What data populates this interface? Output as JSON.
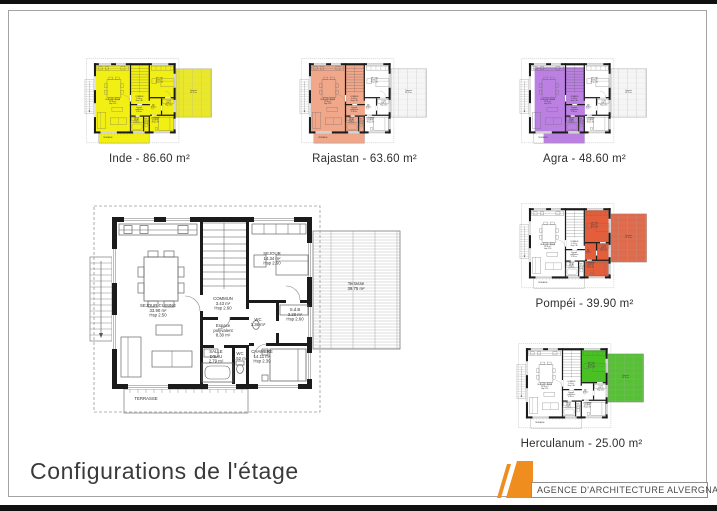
{
  "page": {
    "title": "Configurations de l'étage",
    "footer_logo": {
      "agency": "AGENCE D'ARCHITECTURE ALVERGNAT",
      "accent_color": "#ef8d1e"
    }
  },
  "configurations": [
    {
      "name": "Inde",
      "label": "Inde - 86.60 m²",
      "area": "86.60 m²",
      "color": "#f2ef14",
      "zones": [
        [
          29,
          25,
          190,
          162
        ],
        [
          225,
          34,
          87,
          118
        ],
        [
          36,
          192,
          124,
          24
        ]
      ]
    },
    {
      "name": "Rajastan",
      "label": "Rajastan - 63.60 m²",
      "area": "63.60 m²",
      "color": "#f0a78a",
      "zones": [
        [
          29,
          25,
          132,
          162
        ],
        [
          36,
          192,
          124,
          24
        ]
      ]
    },
    {
      "name": "Agra",
      "label": "Agra - 48.60 m²",
      "area": "48.60 m²",
      "color": "#bb80e2",
      "zones": [
        [
          38,
          30,
          123,
          157
        ],
        [
          60,
          192,
          100,
          24
        ]
      ]
    },
    {
      "name": "Pompéi",
      "label": "Pompéi - 39.90 m²",
      "area": "39.90 m²",
      "color": "#e55e3b",
      "zones": [
        [
          161,
          25,
          58,
          162
        ],
        [
          225,
          34,
          87,
          118
        ]
      ]
    },
    {
      "name": "Herculanum",
      "label": "Herculanum - 25.00 m²",
      "area": "25.00 m²",
      "color": "#49c123",
      "zones": [
        [
          161,
          25,
          58,
          81
        ],
        [
          225,
          34,
          87,
          118
        ]
      ]
    }
  ],
  "main_plan": {
    "labels": [
      {
        "x": 70,
        "y": 110,
        "lines": [
          "SEJOUR CUISINE",
          "33.90 m²",
          "Hsp 2.50"
        ]
      },
      {
        "x": 135,
        "y": 103,
        "lines": [
          "COMMUN",
          "3.43 m²",
          "Hsp 2.60"
        ]
      },
      {
        "x": 184,
        "y": 58,
        "lines": [
          "SEJOUR",
          "14.34 m²",
          "Hsp 2.60"
        ]
      },
      {
        "x": 207,
        "y": 114,
        "lines": [
          "S.d.B",
          "3.28 m²",
          "Hsp 2.60"
        ]
      },
      {
        "x": 170,
        "y": 124,
        "lines": [
          "WC",
          "1.36 m²"
        ]
      },
      {
        "x": 135,
        "y": 130,
        "lines": [
          "Espace",
          "polyvalent",
          "8.30 m²"
        ]
      },
      {
        "x": 128,
        "y": 156,
        "lines": [
          "SALLE",
          "D'EAU",
          "2.79 m²"
        ]
      },
      {
        "x": 152,
        "y": 158,
        "lines": [
          "WC",
          "1.52 m²"
        ]
      },
      {
        "x": 174,
        "y": 156,
        "lines": [
          "CHAMBRE",
          "14.11 m²",
          "Hsp 2.39"
        ]
      },
      {
        "x": 58,
        "y": 203,
        "lines": [
          "TERRASSE"
        ]
      },
      {
        "x": 268,
        "y": 88,
        "lines": [
          "Terrasse",
          "39.75 m²"
        ]
      }
    ]
  }
}
